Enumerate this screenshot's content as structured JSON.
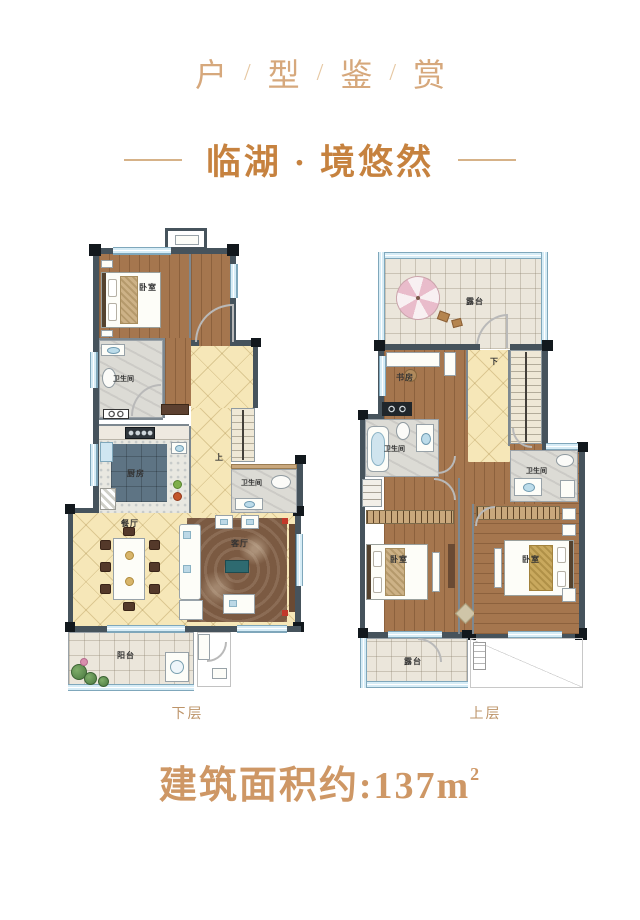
{
  "header": {
    "title_chars": [
      "户",
      "型",
      "鉴",
      "赏"
    ],
    "title_separator": "/",
    "subtitle": "临湖 · 境悠然"
  },
  "plans": {
    "lower": {
      "caption": "下层",
      "labels": {
        "bedroom": "卧室",
        "bath1": "卫生间",
        "kitchen": "厨房",
        "bath2": "卫生间",
        "dining": "餐厅",
        "living": "客厅",
        "balcony": "阳台",
        "stairs_dir": "上"
      }
    },
    "upper": {
      "caption": "上层",
      "labels": {
        "terrace_top": "露台",
        "study": "书房",
        "bath_left": "卫生间",
        "bath_right": "卫生间",
        "bedroom_left": "卧室",
        "bedroom_right": "卧室",
        "terrace_bottom": "露台",
        "stairs_dir": "下"
      }
    }
  },
  "footer": {
    "area_text": "建筑面积约:137m",
    "area_superscript": "2"
  },
  "colors": {
    "title": "#d6a87c",
    "subtitle": "#c6823f",
    "caption": "#bd9469",
    "area_text_color": "#ce9765",
    "wall": "#46535c",
    "window": "#cfe7f2",
    "wood_floor": "#a5764e",
    "tile_yellow": "#f6e7b8",
    "terrace_tile": "#ebe6db"
  }
}
